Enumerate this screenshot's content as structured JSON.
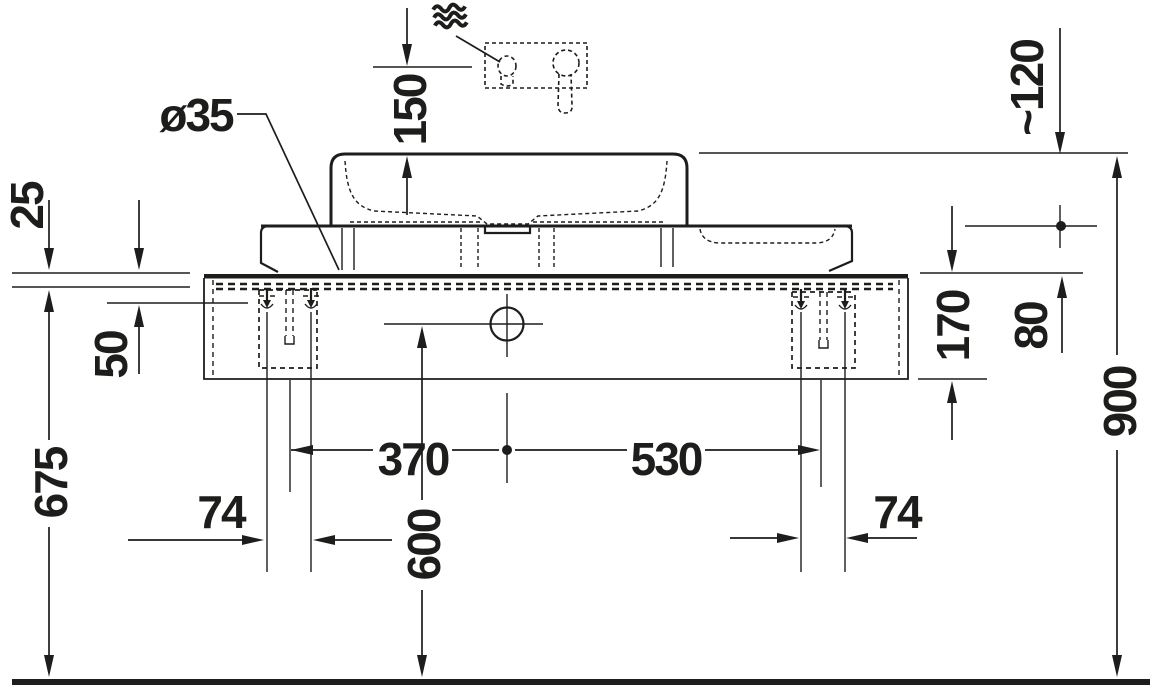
{
  "page": {
    "background": "#ffffff",
    "line_color": "#1d1d1b",
    "view": "front elevation"
  },
  "labels": {
    "tap_hole_diameter": "ø35",
    "spout_to_rim_height": "150",
    "spout_clearance": "~120",
    "top_edge_offset": "25",
    "fixing_offset_from_top": "50",
    "console_thickness": "80",
    "cabinet_height": "170",
    "rim_total_height": "900",
    "fixing_height_from_floor": "675",
    "outlet_height_from_floor": "600",
    "center_to_left_bracket": "370",
    "center_to_right_bracket": "530",
    "left_fixing_spacing": "74",
    "right_fixing_spacing": "74"
  },
  "icons": {
    "hot_water": "wavy-lines-water-icon",
    "faucet": "wall-mounted-mixer-dashed",
    "fixing": "anchor-screw-marker",
    "reference": "filled-dot-marker"
  }
}
